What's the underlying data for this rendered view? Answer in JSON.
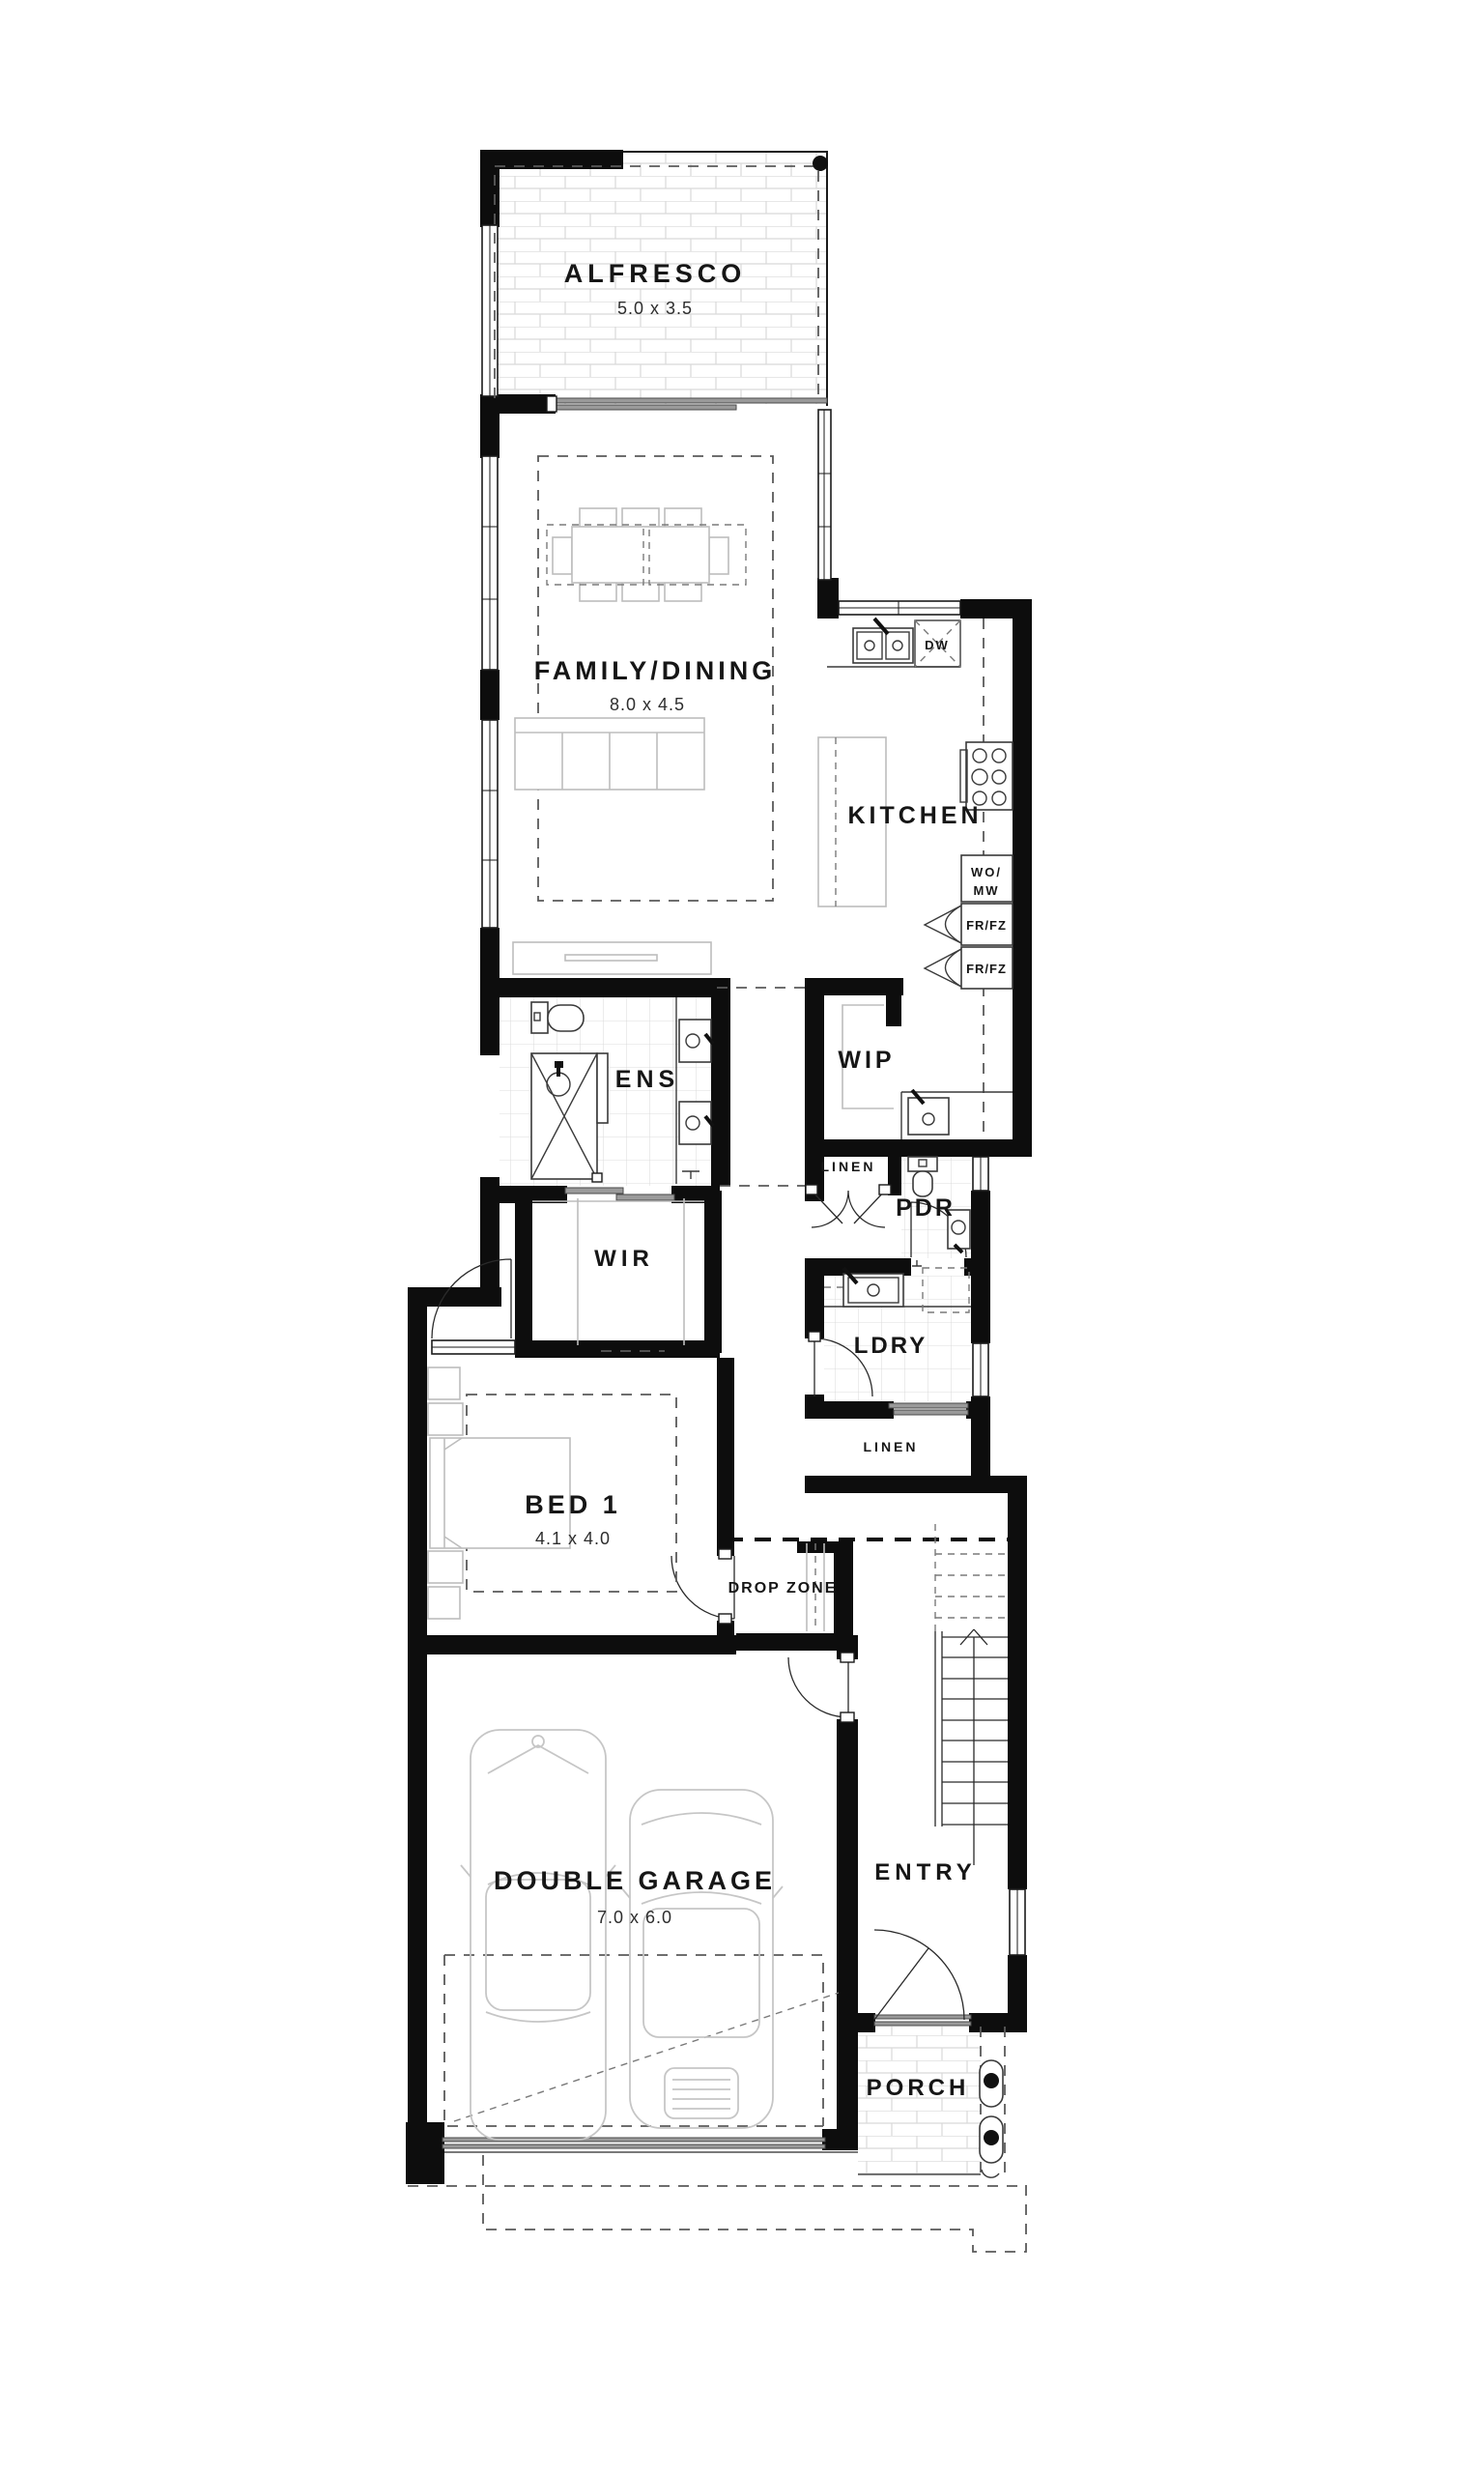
{
  "plan": {
    "rooms": {
      "alfresco": {
        "name": "ALFRESCO",
        "dims": "5.0 x 3.5"
      },
      "family_dining": {
        "name": "FAMILY/DINING",
        "dims": "8.0 x 4.5"
      },
      "kitchen": {
        "name": "KITCHEN"
      },
      "ens": {
        "name": "ENS"
      },
      "wip": {
        "name": "WIP"
      },
      "linen1": {
        "name": "LINEN"
      },
      "pdr": {
        "name": "PDR"
      },
      "wir": {
        "name": "WIR"
      },
      "ldry": {
        "name": "LDRY"
      },
      "linen2": {
        "name": "LINEN"
      },
      "bed1": {
        "name": "BED 1",
        "dims": "4.1 x 4.0"
      },
      "drop_zone": {
        "name": "DROP ZONE"
      },
      "garage": {
        "name": "DOUBLE GARAGE",
        "dims": "7.0 x 6.0"
      },
      "entry": {
        "name": "ENTRY"
      },
      "porch": {
        "name": "PORCH"
      }
    },
    "appliances": {
      "dw": "DW",
      "wo_mw_line1": "WO/",
      "wo_mw_line2": "MW",
      "fr_fz": "FR/FZ"
    },
    "colors": {
      "wall": "#0d0d0d",
      "furniture_line": "#bdbdbd",
      "fixture_line": "#3a3a3a",
      "dashed_line": "#5a5a5a",
      "tile_line": "#dcdcdc",
      "background": "#ffffff"
    }
  }
}
